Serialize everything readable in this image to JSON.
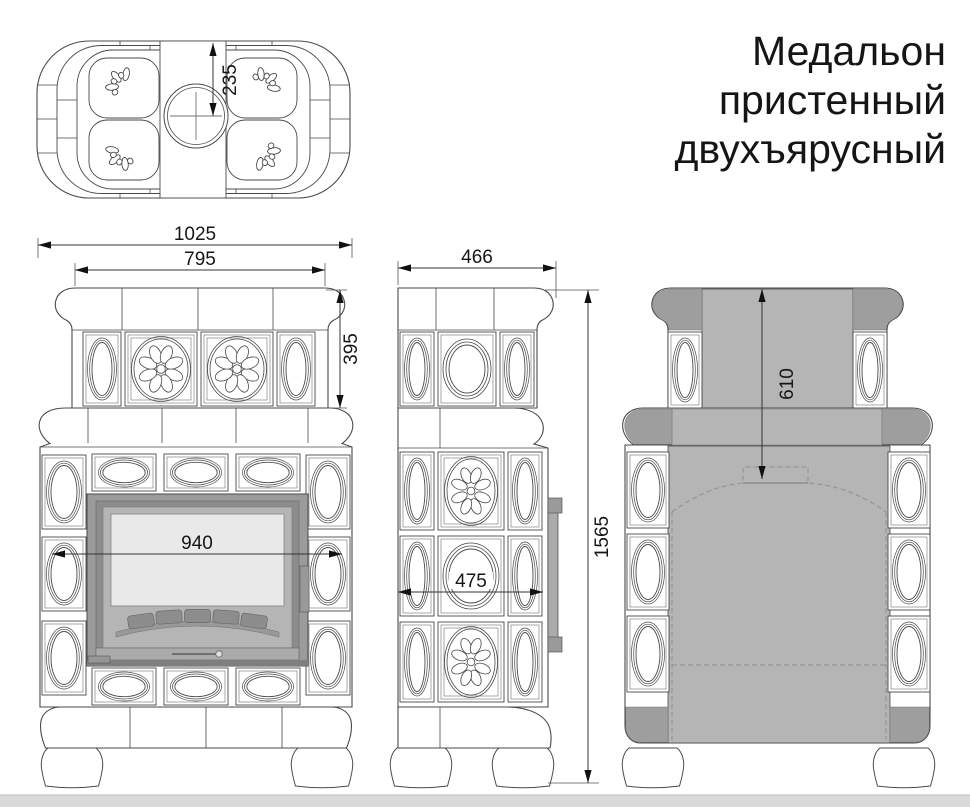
{
  "title": {
    "lines": [
      "Медальон",
      "пристенный",
      "двухъярусный"
    ]
  },
  "dimensions": {
    "chimney_offset": "235",
    "overall_width": "1025",
    "upper_tier_width": "795",
    "upper_tier_height": "395",
    "body_width_at_firebox": "940",
    "depth": "466",
    "body_depth": "475",
    "overall_height": "1565",
    "rear_upper_section_height": "610"
  }
}
